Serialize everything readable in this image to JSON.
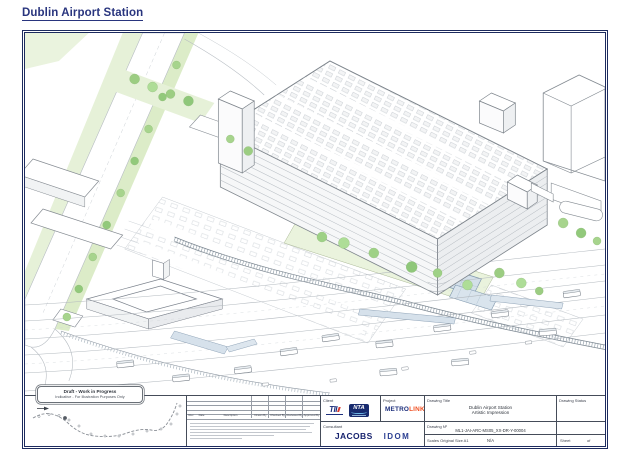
{
  "page": {
    "title": "Dublin Airport Station"
  },
  "drawing": {
    "draft_box_line1": "Draft - Work in Progress",
    "draft_box_line2": "Indicative - For Illustration Purposes Only",
    "key_plan_label": "Key Plan"
  },
  "title_block": {
    "labels": {
      "client": "Client",
      "project": "Project",
      "consultant": "Consultant",
      "drawing_title": "Drawing Title",
      "drawing_status": "Drawing Status",
      "drawing_no": "Drawing Nº",
      "scales": "Scales Original Size A1",
      "sheet": "Sheet",
      "of": "of"
    },
    "values": {
      "drawing_title_line1": "Dublin Airport Station",
      "drawing_title_line2": "Artistic Impression",
      "drawing_no": "ML1-JAI-ARC-MS05_XX-DR-Y-00004",
      "scale": "N/A"
    },
    "revision_table": {
      "rev": "Rev",
      "date": "Date",
      "description": "Description",
      "drawn": "Drawn By",
      "checked": "Checked By",
      "reviewed": "Reviewed By",
      "approved": "Approved By"
    },
    "logos": {
      "tii": "TII",
      "nta": "NTA",
      "metro": "METRO",
      "link": "LINK",
      "jacobs": "JACOBS",
      "idom": "IDOM"
    }
  },
  "colors": {
    "frame_navy": "#1c2a5e",
    "title_blue": "#29357e",
    "metrolink_orange": "#f05123",
    "entrance_orange": "#e9a13f",
    "tree_green": "#a7d48d",
    "landscape_green": "#dcecc8",
    "canopy_blue": "#d3dfe9"
  }
}
